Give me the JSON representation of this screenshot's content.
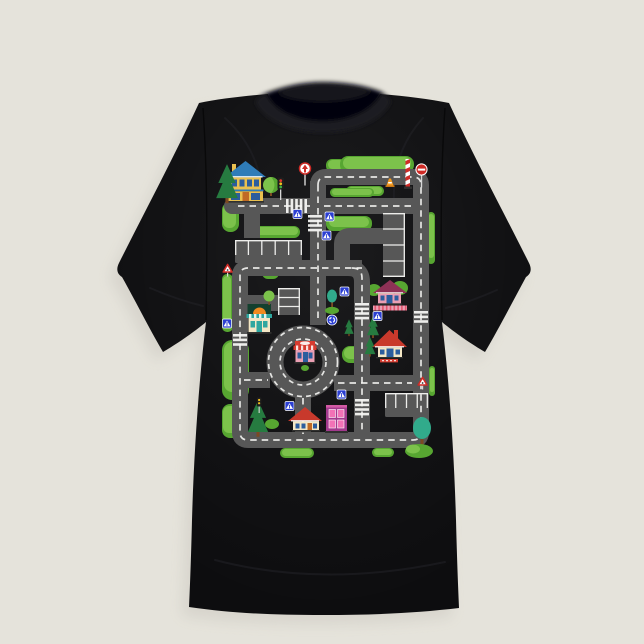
{
  "product": {
    "type": "t-shirt product photo",
    "shirt_color_name": "black",
    "view": "front flat lay on light backdrop",
    "print_subject": "kids road play mat city map"
  },
  "palette": {
    "bg": "#eae7e0",
    "bg_shadow": "#d6d3cb",
    "shirt": "#0d0d0f",
    "shirt_fold": "#232328",
    "collar_band": "#1d1d22",
    "collar_hole": "#060607",
    "road": "#575757",
    "road_line": "#f5f5f3",
    "grass_light": "#7cc24b",
    "grass_mid": "#57a631",
    "pine_green": "#267b40",
    "teal_green": "#31ab8b",
    "trunk_brown": "#7c4a22",
    "sign_blue": "#2b3fd2",
    "sign_red": "#cf2b26",
    "cone_orange": "#f59a1e",
    "roof_red": "#c8392c",
    "roof_maroon": "#8e3156",
    "roof_blue": "#2f7cb8",
    "wall_yellow": "#e9c050",
    "wall_cream": "#f4e7c6",
    "wall_pink": "#eb9fb4",
    "wall_purple": "#a23a8d",
    "window_blue": "#2c5d9e",
    "window_pink": "#f272b6",
    "window_teal": "#2fa7a0",
    "door_orange": "#c06a25",
    "awning_red": "#d63c30",
    "dome_orange": "#f08a20",
    "shop_dark": "#14402e",
    "fence_pink": "#e2566e",
    "base_dark": "#30302f"
  },
  "design": {
    "elements": [
      "two-story house with blue roof",
      "pink house with maroon roof and striped fence",
      "red-roof house with chimney",
      "red-roof cottage on bottom road",
      "purple building with pink windows",
      "bakery shop with orange dome sign",
      "roundabout with shop in center",
      "parking lot top-left",
      "small parking lot center-left",
      "tall parking lot right",
      "parking lot bottom-right",
      "railroad barrier pole",
      "no-entry sign",
      "traffic cone",
      "priority arrow sign",
      "traffic lights",
      "pedestrian-crossing blue signs",
      "roundabout blue sign",
      "warning triangle signs",
      "zebra crossings",
      "pine trees, round trees, teal trees, hedges"
    ]
  }
}
